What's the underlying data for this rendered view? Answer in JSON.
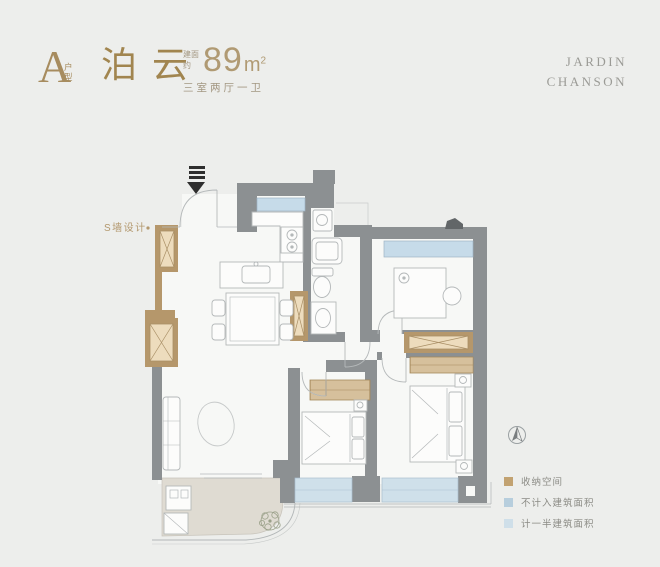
{
  "header": {
    "unit_letter": "A",
    "unit_type": "户型",
    "name": "泊云",
    "area_prefix": "建面约",
    "area_value": "89",
    "area_unit": "m",
    "area_unit_sup": "2",
    "rooms": "三室两厅一卫"
  },
  "brand": {
    "line1": "JARDIN",
    "line2": "CHANSON"
  },
  "plan": {
    "s_wall_label": "S墙设计"
  },
  "legend": {
    "items": [
      {
        "label": "收纳空间",
        "color": "#c2a271"
      },
      {
        "label": "不计入建筑面积",
        "color": "#b7cedd"
      },
      {
        "label": "计一半建筑面积",
        "color": "#cfdfe9"
      }
    ]
  },
  "colors": {
    "accent_bronze": "#a78c5f",
    "brand_gray": "#9b9b96",
    "wall_gray": "#8c9092",
    "window_blue": "#c6dbe9",
    "bay_blue": "#cfe0ea",
    "storage_tan": "#b5976b",
    "storage_fill": "#eddcbd",
    "balcony_floor": "#dfdbd2",
    "background": "#edeeec"
  }
}
